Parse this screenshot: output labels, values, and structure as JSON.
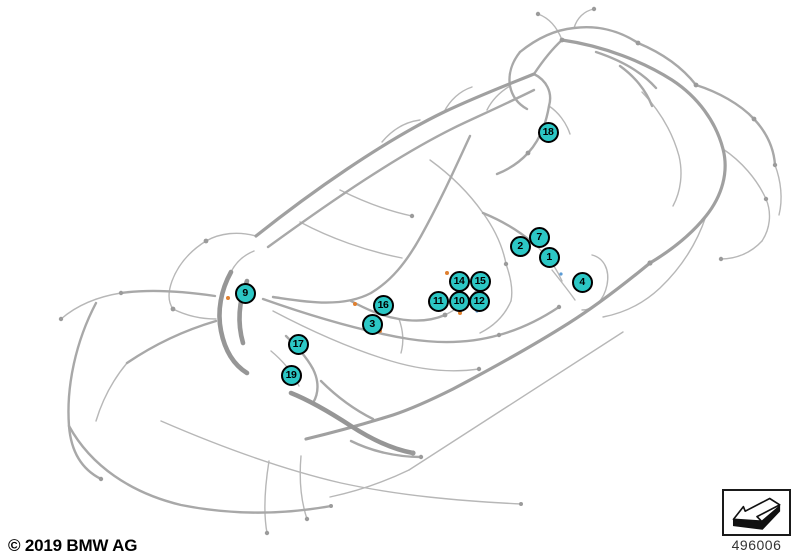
{
  "footer": {
    "copyright": "© 2019 BMW AG"
  },
  "thumbnail": {
    "number": "496006",
    "icon": "arrow-3d-left-icon"
  },
  "colors": {
    "background": "#ffffff",
    "callout_fill": "#2cc7c5",
    "callout_border": "#000000",
    "callout_text": "#000000",
    "harness_light": "#b7b7b7",
    "harness_medium": "#a8a8a8",
    "harness_trunk": "#a0a0a0",
    "harness_dense": "#969696",
    "connector_orange": "#e08030",
    "connector_blue": "#5b9bd5"
  },
  "callouts": [
    {
      "label": "1",
      "x": 549,
      "y": 257
    },
    {
      "label": "2",
      "x": 520,
      "y": 246
    },
    {
      "label": "3",
      "x": 372,
      "y": 324
    },
    {
      "label": "4",
      "x": 582,
      "y": 282
    },
    {
      "label": "7",
      "x": 539,
      "y": 237
    },
    {
      "label": "9",
      "x": 245,
      "y": 293
    },
    {
      "label": "10",
      "x": 459,
      "y": 301
    },
    {
      "label": "11",
      "x": 438,
      "y": 301
    },
    {
      "label": "12",
      "x": 479,
      "y": 301
    },
    {
      "label": "14",
      "x": 459,
      "y": 281
    },
    {
      "label": "15",
      "x": 480,
      "y": 281
    },
    {
      "label": "16",
      "x": 383,
      "y": 305
    },
    {
      "label": "17",
      "x": 298,
      "y": 344
    },
    {
      "label": "18",
      "x": 548,
      "y": 132
    },
    {
      "label": "19",
      "x": 291,
      "y": 375
    }
  ]
}
